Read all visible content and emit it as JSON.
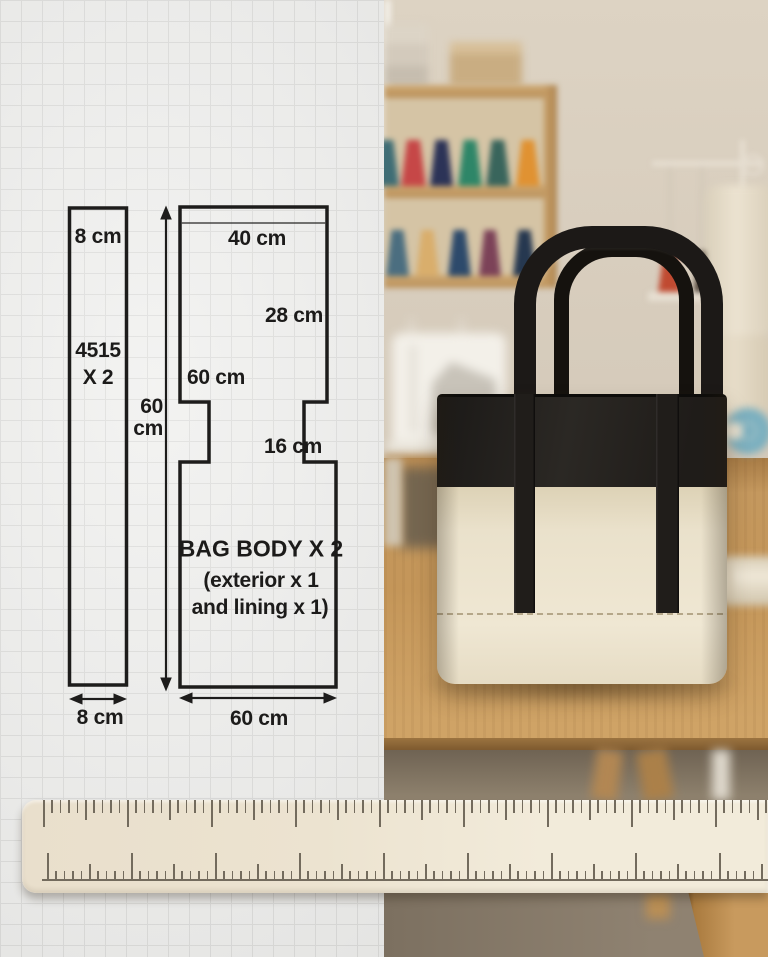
{
  "pattern": {
    "strap_piece": {
      "top_width_label": "8 cm",
      "piece_label_line1": "4515",
      "piece_label_line2": "X 2",
      "bottom_width_label": "8 cm"
    },
    "height_arrow": {
      "value_line1": "60",
      "value_line2": "cm"
    },
    "body_piece": {
      "top_width_label": "40 cm",
      "upper_right_label": "28 cm",
      "left_side_label": "60 cm",
      "notch_label": "16 cm",
      "title": "BAG BODY X 2",
      "subtitle_line1": "(exterior x 1",
      "subtitle_line2": "and lining x 1)",
      "bottom_width_label": "60 cm"
    }
  },
  "photo": {
    "colors": {
      "wall": "#ddd3c3",
      "table": "#c49659",
      "ruler": "#ece3d0",
      "bag_black": "#22201d",
      "bag_cream": "#eae1cb",
      "shelf_cones_top_row": [
        "#3f6d75",
        "#c64747",
        "#2c3357",
        "#2e8668",
        "#39655c",
        "#e09232"
      ],
      "shelf_cones_bottom_row": [
        "#4b6e80",
        "#d9ae6c",
        "#2d4a6b",
        "#7c4258",
        "#263850"
      ],
      "stand_cones": [
        "#c04a31",
        "#463a30",
        "#2f4e6a"
      ]
    }
  }
}
